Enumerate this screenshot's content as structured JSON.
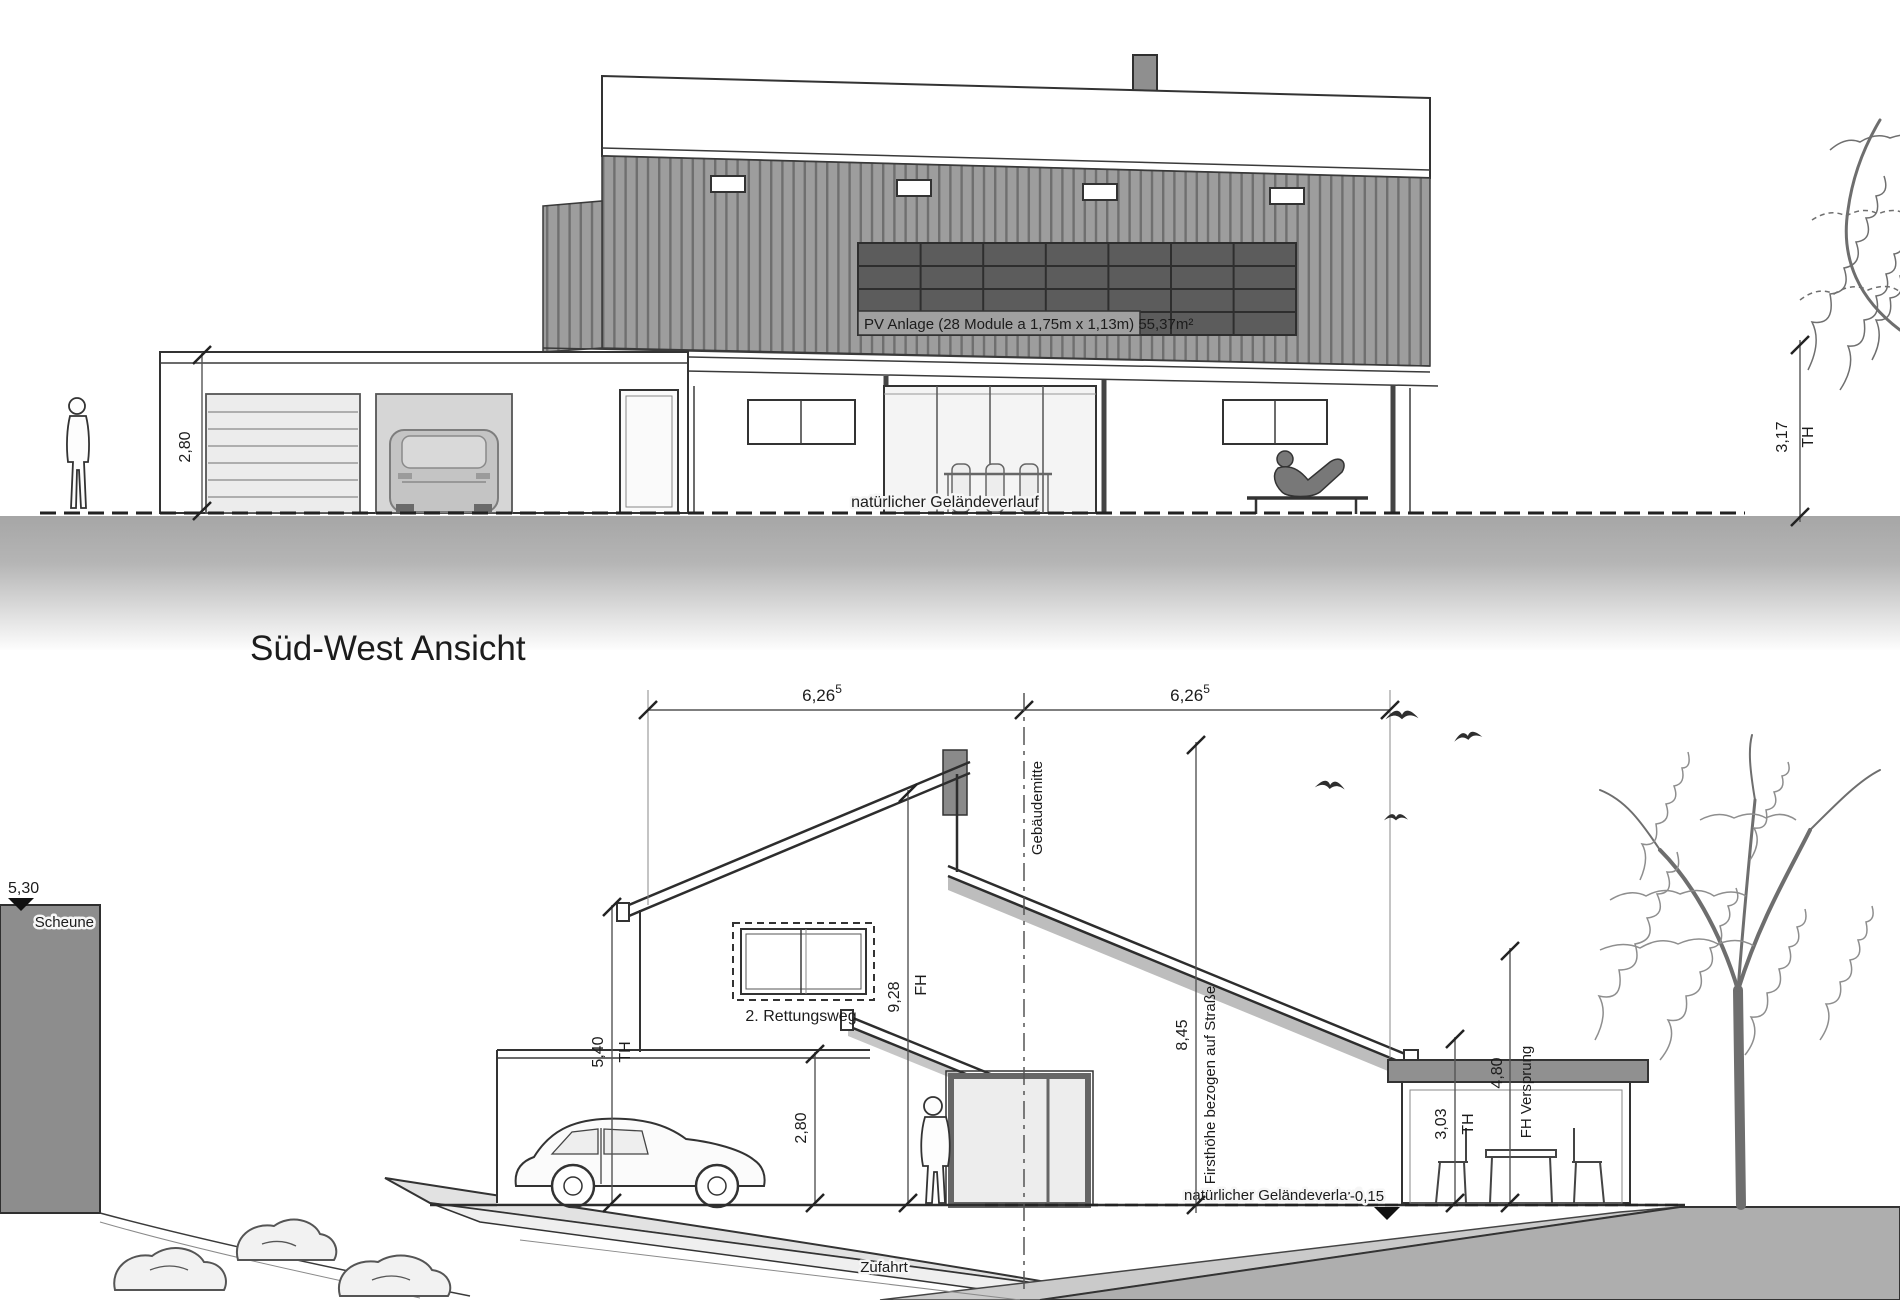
{
  "palette": {
    "line": "#333333",
    "cladding": "#9d9d9d",
    "cladding_stripe": "#6f6f6f",
    "pv_panel": "#5c5c5c",
    "ground_band": "#a6a6a6",
    "barn": "#8d8d8d"
  },
  "title": {
    "section_label": "Süd-West Ansicht"
  },
  "top_view": {
    "pv_label": "PV Anlage (28 Module a 1,75m x 1,13m) 55,37m²",
    "ground_label": "natürlicher Geländeverlauf",
    "dim_garage_height": "2,80",
    "dim_eaves_height": "3,17",
    "dim_eaves_suffix": "TH"
  },
  "section_view": {
    "dim_span_left": "6,26",
    "dim_span_left_sup": "5",
    "dim_span_right": "6,26",
    "dim_span_right_sup": "5",
    "barn_label": "Scheune",
    "barn_level": "5,30",
    "rescue_window_label": "2. Rettungsweg",
    "center_axis_label": "Gebäudemitte",
    "driveway_label": "Zufahrt",
    "ground_label": "natürlicher Geländeverlauf",
    "ground_offset": "-0,15",
    "dim_eaves_left": "5,40",
    "dim_eaves_left_suffix": "TH",
    "dim_garage_height": "2,80",
    "dim_ridge": "9,28",
    "dim_ridge_suffix": "FH",
    "dim_ridge_street": "8,45",
    "dim_ridge_street_label": "Firsthöhe bezogen auf Straße",
    "dim_conservatory": "3,03",
    "dim_conservatory_suffix": "TH",
    "dim_offset_height": "4,80",
    "dim_offset_label": "FH Versprung"
  }
}
